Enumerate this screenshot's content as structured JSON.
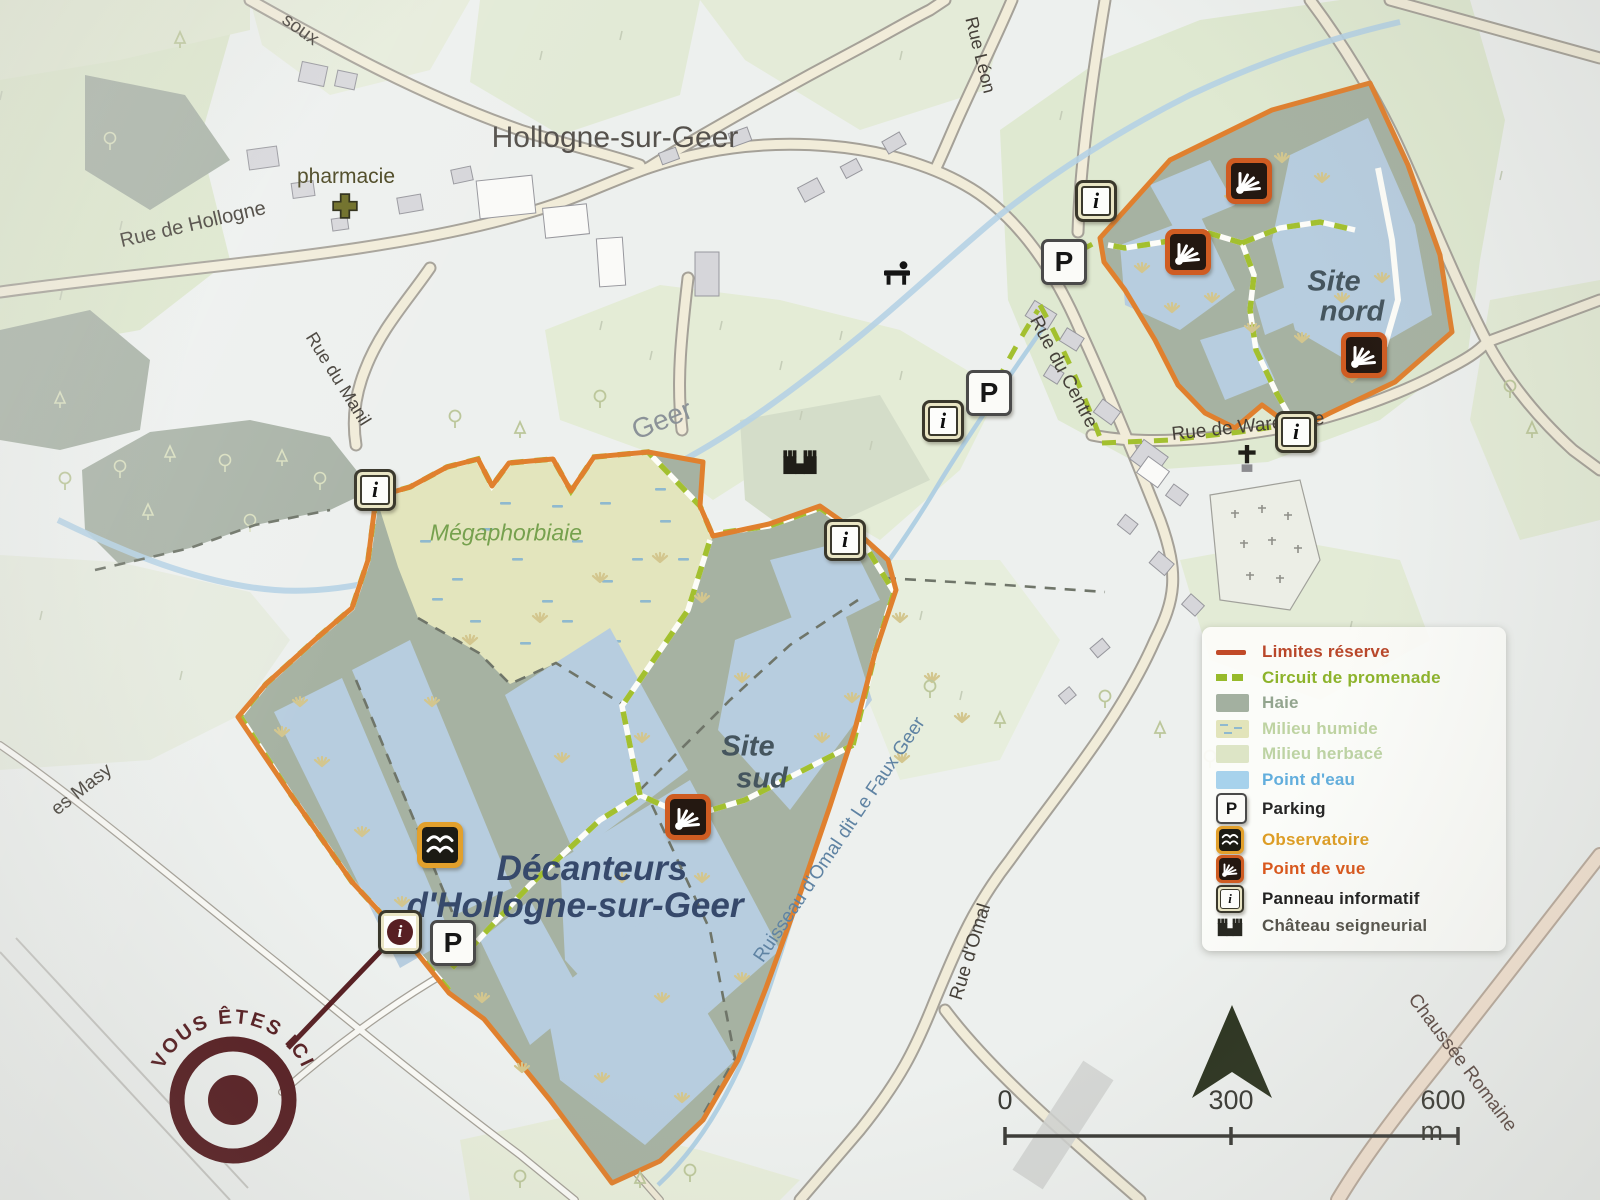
{
  "map_title": {
    "village": "Hollogne-sur-Geer",
    "reserve_line1": "Décanteurs",
    "reserve_line2": "d'Hollogne-sur-Geer",
    "site_sud_line1": "Site",
    "site_sud_line2": "sud",
    "site_nord_line1": "Site",
    "site_nord_line2": "nord",
    "marsh": "Mégaphorbiaie",
    "river": "Geer",
    "stream": "Ruisseau d'Omal dit Le Faux Geer",
    "pharmacy": "pharmacie"
  },
  "streets": {
    "rue_de_hollogne": "Rue de Hollogne",
    "rue_du_manil": "Rue du Manil",
    "rue_leon": "Rue Léon",
    "rue_du_centre": "Rue du Centre",
    "rue_de_waremme": "Rue de Waremme",
    "rue_d_omal": "Rue d'Omal",
    "chaussee_romaine": "Chaussée Romaine",
    "masy": "es Masy",
    "soux": "soux"
  },
  "glyphs": {
    "parking": "P",
    "info": "i"
  },
  "you_are_here": "VOUS ÊTES ICI",
  "scale": {
    "start": "0",
    "middle": "300",
    "end": "600 m"
  },
  "legend": {
    "items": [
      {
        "label": "Limites réserve",
        "color": "#b9472a",
        "symbol": "reserve-boundary-line"
      },
      {
        "label": "Circuit de promenade",
        "color": "#8db32b",
        "symbol": "walking-circuit-dashes"
      },
      {
        "label": "Haie",
        "color": "#93a58f",
        "symbol": "hedge-swatch"
      },
      {
        "label": "Milieu humide",
        "color": "#bed3a2",
        "symbol": "wetland-swatch"
      },
      {
        "label": "Milieu herbacé",
        "color": "#bdd3a4",
        "symbol": "grassland-swatch"
      },
      {
        "label": "Point d'eau",
        "color": "#62aedd",
        "symbol": "water-swatch"
      },
      {
        "label": "Parking",
        "color": "#262626",
        "symbol": "parking-icon"
      },
      {
        "label": "Observatoire",
        "color": "#dd9d25",
        "symbol": "observatory-icon"
      },
      {
        "label": "Point de vue",
        "color": "#d9571c",
        "symbol": "viewpoint-icon"
      },
      {
        "label": "Panneau informatif",
        "color": "#1f1f1f",
        "symbol": "info-panel-icon"
      },
      {
        "label": "Château seigneurial",
        "color": "#55534b",
        "symbol": "castle-icon"
      }
    ]
  },
  "colors": {
    "reserve_boundary": "#e0802e",
    "circuit_green": "#a3c02f",
    "pond_blue": "#b7cddf",
    "hedge_green_gray": "#a6b2a2",
    "wetland_yellow_green": "#e3e5bd",
    "road_cream": "#f1ecd9",
    "marker_maroon": "#571f23",
    "north_arrow": "#2c3420"
  }
}
